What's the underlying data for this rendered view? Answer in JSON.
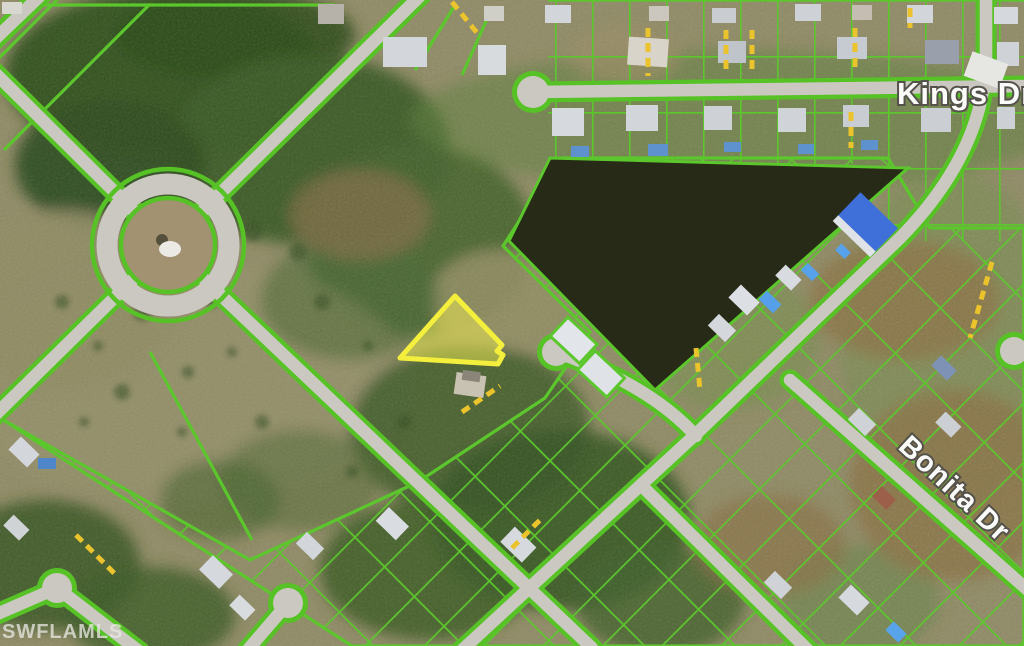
{
  "map": {
    "type": "aerial-parcel-map",
    "watermark": "SWFLAMLS",
    "street_labels": [
      {
        "name": "Kings Dr"
      },
      {
        "name": "Bonita Dr"
      }
    ],
    "highlighted_parcel": {
      "description": "vacant triangular lot outlined in yellow",
      "border_color": "#f3ef3c",
      "fill_color": "rgba(244,240,80,0.5)"
    },
    "features": [
      "roundabout",
      "lake",
      "cul-de-sacs",
      "parcel-grid",
      "houses",
      "driveway-markers"
    ],
    "colors": {
      "parcel_line": "#5cc72d",
      "road": "#cbc8c1",
      "lake": "#262a16",
      "driveway_marker": "#eac32d",
      "terrain_base": "#8f8a64"
    }
  }
}
